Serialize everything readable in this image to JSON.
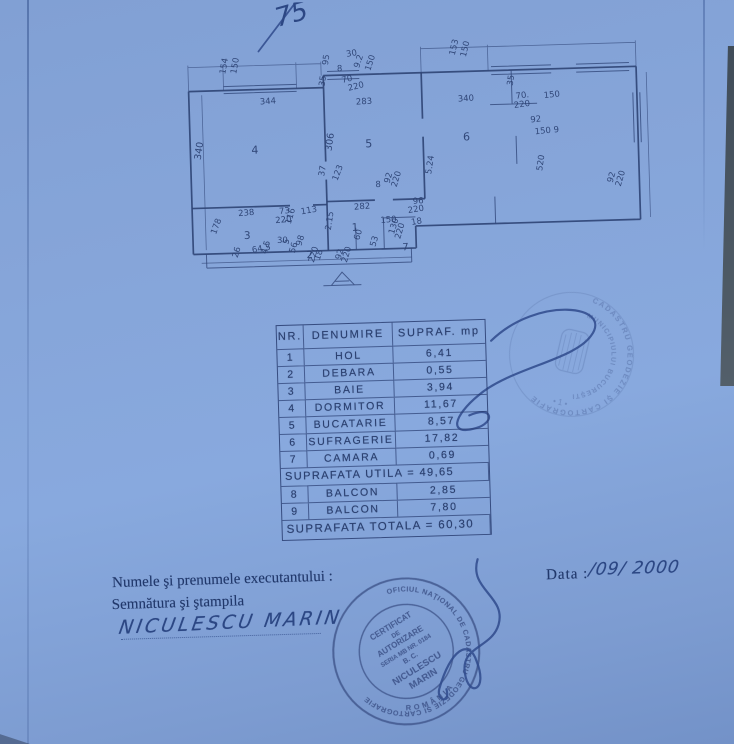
{
  "photo": {
    "handwritten_top": "75",
    "signature_name": "NICULESCU MARIN",
    "date_value": "/09/ 2000"
  },
  "footer": {
    "line1": "Numele şi prenumele executantului :",
    "line2": "Semnătura şi ştampila",
    "date_label": "Data :"
  },
  "table": {
    "headers": [
      "NR.",
      "DENUMIRE",
      "SUPRAF. mp"
    ],
    "rows": [
      [
        "1",
        "HOL",
        "6,41"
      ],
      [
        "2",
        "DEBARA",
        "0,55"
      ],
      [
        "3",
        "BAIE",
        "3,94"
      ],
      [
        "4",
        "DORMITOR",
        "11,67"
      ],
      [
        "5",
        "BUCATARIE",
        "8,57"
      ],
      [
        "6",
        "SUFRAGERIE",
        "17,82"
      ],
      [
        "7",
        "CAMARA",
        "0,69"
      ]
    ],
    "subtotal": "SUPRAFATA UTILA = 49,65",
    "rows2": [
      [
        "8",
        "BALCON",
        "2,85"
      ],
      [
        "9",
        "BALCON",
        "7,80"
      ]
    ],
    "total": "SUPRAFATA TOTALA = 60,30"
  },
  "plan": {
    "labels": [
      {
        "t": "154",
        "x": 234,
        "y": 70,
        "r": -78
      },
      {
        "t": "150",
        "x": 245,
        "y": 70,
        "r": -78
      },
      {
        "t": "95",
        "x": 337,
        "y": 64,
        "r": -80
      },
      {
        "t": "30",
        "x": 356,
        "y": 56,
        "r": -8
      },
      {
        "t": "8",
        "x": 346,
        "y": 70,
        "r": 0
      },
      {
        "t": "9.2",
        "x": 368,
        "y": 68,
        "r": -70
      },
      {
        "t": "150",
        "x": 379,
        "y": 71,
        "r": -70
      },
      {
        "t": "35",
        "x": 333,
        "y": 85,
        "r": -80
      },
      {
        "t": "70",
        "x": 351,
        "y": 82,
        "r": -12
      },
      {
        "t": "220",
        "x": 357,
        "y": 90,
        "r": -12
      },
      {
        "t": "153",
        "x": 464,
        "y": 58,
        "r": -75
      },
      {
        "t": "150",
        "x": 475,
        "y": 60,
        "r": -75
      },
      {
        "t": "344",
        "x": 268,
        "y": 101,
        "r": -2
      },
      {
        "t": "283",
        "x": 364,
        "y": 104,
        "r": -2
      },
      {
        "t": "340",
        "x": 466,
        "y": 104,
        "r": -2
      },
      {
        "t": "35",
        "x": 521,
        "y": 90,
        "r": -80
      },
      {
        "t": "70.",
        "x": 524,
        "y": 103,
        "r": -6
      },
      {
        "t": "220",
        "x": 522,
        "y": 112,
        "r": -6
      },
      {
        "t": "150",
        "x": 552,
        "y": 103,
        "r": -4
      },
      {
        "t": "92",
        "x": 538,
        "y": 127,
        "r": -4
      },
      {
        "t": "150 9",
        "x": 542,
        "y": 139,
        "r": -4
      },
      {
        "t": "340",
        "x": 207,
        "y": 155,
        "r": -80,
        "s": 9.5
      },
      {
        "t": "4",
        "x": 258,
        "y": 150,
        "r": 0,
        "s": 11
      },
      {
        "t": "306",
        "x": 338,
        "y": 150,
        "r": -80,
        "s": 9.5
      },
      {
        "t": "5",
        "x": 372,
        "y": 147,
        "r": 0,
        "s": 11
      },
      {
        "t": "6",
        "x": 470,
        "y": 143,
        "r": 0,
        "s": 11
      },
      {
        "t": "5.24",
        "x": 437,
        "y": 176,
        "r": -80
      },
      {
        "t": "520",
        "x": 548,
        "y": 176,
        "r": -80
      },
      {
        "t": "37",
        "x": 330,
        "y": 175,
        "r": -80
      },
      {
        "t": "123",
        "x": 343,
        "y": 180,
        "r": -68
      },
      {
        "t": "8",
        "x": 381,
        "y": 187,
        "r": 0
      },
      {
        "t": "92",
        "x": 395,
        "y": 184,
        "r": -72
      },
      {
        "t": "220",
        "x": 402,
        "y": 188,
        "r": -72
      },
      {
        "t": "92",
        "x": 618,
        "y": 190,
        "r": -72
      },
      {
        "t": "220",
        "x": 626,
        "y": 194,
        "r": -72
      },
      {
        "t": "238",
        "x": 243,
        "y": 212,
        "r": -3
      },
      {
        "t": "73",
        "x": 284,
        "y": 211,
        "r": -3
      },
      {
        "t": "113",
        "x": 306,
        "y": 212,
        "r": -8
      },
      {
        "t": "220",
        "x": 280,
        "y": 220,
        "r": -3
      },
      {
        "t": "116",
        "x": 295,
        "y": 222,
        "r": -72
      },
      {
        "t": "282",
        "x": 359,
        "y": 209,
        "r": -3
      },
      {
        "t": "96",
        "x": 418,
        "y": 205,
        "r": -3
      },
      {
        "t": "220",
        "x": 413,
        "y": 214,
        "r": -8
      },
      {
        "t": "150",
        "x": 385,
        "y": 223,
        "r": -3
      },
      {
        "t": "18",
        "x": 416,
        "y": 226,
        "r": -8
      },
      {
        "t": "178",
        "x": 220,
        "y": 230,
        "r": -68
      },
      {
        "t": "3",
        "x": 248,
        "y": 235,
        "r": 0,
        "s": 10.5
      },
      {
        "t": "2.15",
        "x": 335,
        "y": 229,
        "r": -80
      },
      {
        "t": "1",
        "x": 356,
        "y": 230,
        "r": 0,
        "s": 10.5
      },
      {
        "t": "130",
        "x": 398,
        "y": 235,
        "r": -72
      },
      {
        "t": "220",
        "x": 404,
        "y": 240,
        "r": -72
      },
      {
        "t": "30",
        "x": 281,
        "y": 240,
        "r": 0
      },
      {
        "t": "5",
        "x": 292,
        "y": 242,
        "r": -72
      },
      {
        "t": "98",
        "x": 305,
        "y": 244,
        "r": -72
      },
      {
        "t": "56",
        "x": 298,
        "y": 251,
        "r": -72
      },
      {
        "t": "64.5",
        "x": 256,
        "y": 249,
        "r": -8
      },
      {
        "t": "4.5",
        "x": 270,
        "y": 251,
        "r": -72
      },
      {
        "t": "26",
        "x": 241,
        "y": 254,
        "r": -72
      },
      {
        "t": "2",
        "x": 310,
        "y": 256,
        "r": 0,
        "s": 10
      },
      {
        "t": "220",
        "x": 317,
        "y": 261,
        "r": -72
      },
      {
        "t": "18",
        "x": 323,
        "y": 259,
        "r": -72
      },
      {
        "t": "60",
        "x": 363,
        "y": 240,
        "r": -72
      },
      {
        "t": "53",
        "x": 379,
        "y": 247,
        "r": -72
      },
      {
        "t": "92",
        "x": 344,
        "y": 259,
        "r": -72
      },
      {
        "t": "220",
        "x": 350,
        "y": 262,
        "r": -72
      },
      {
        "t": "7",
        "x": 406,
        "y": 251,
        "r": 0,
        "s": 10
      }
    ]
  },
  "stamps": {
    "round_faint": {
      "arc_outer": "CADASTRU GEODEZIE ŞI CARTOGRAFIE",
      "arc_inner": "MUNICIPIULUI BUCUREŞTI",
      "bottom": "• 1 •"
    },
    "round_dark": {
      "arc_outer": "OFICIUL NAŢIONAL DE CADASTRU GEODEZIE ŞI CARTOGRAFIE",
      "arc_bottom": "ROMÂNIA",
      "lines": [
        "CERTIFICAT",
        "DE",
        "AUTORIZARE",
        "SERIA MB NR. 0184",
        "B. C.",
        "NICULESCU",
        "MARIN"
      ]
    }
  },
  "colors": {
    "paper": "#86a5d9",
    "ink": "#2b4070",
    "stamp": "#3a4f85"
  }
}
